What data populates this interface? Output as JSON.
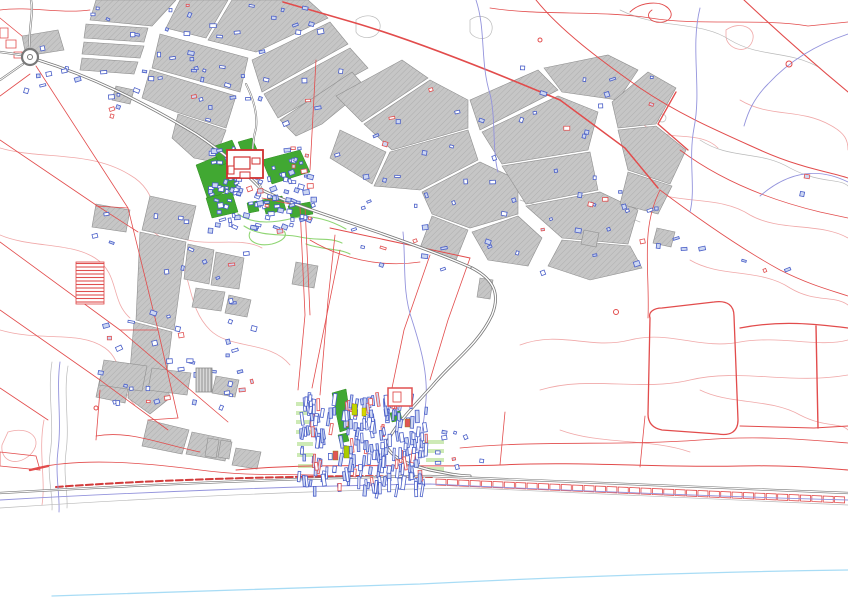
{
  "app": {
    "title": "Cadastral GIS map view"
  },
  "canvas": {
    "width": 848,
    "height": 599,
    "background": "#ffffff"
  },
  "palette": {
    "parcel_fill": "#c6c6c6",
    "parcel_hatch": "#aeaeae",
    "parcel_stroke": "#8f8f8f",
    "red": "#e24c4c",
    "red_dark": "#d23b3b",
    "pink": "#f0a8a8",
    "green": "#41a832",
    "green_stroke": "#2f8c20",
    "light_green": "#cdeab5",
    "track_green": "#8fd573",
    "blue": "#4a5fc8",
    "blue_fill": "#cdd7f2",
    "purple": "#9393dc",
    "coast_blue": "#a8dcf5",
    "road": "#787878",
    "road_core": "#ffffff",
    "gray_line": "#b9b9b9"
  },
  "map": {
    "contours_pink": [
      "M0,148 C40,160 90,150 130,175 C160,192 150,220 175,235 C200,250 240,235 262,248",
      "M0,235 C30,248 70,242 95,258 C120,274 110,300 130,318",
      "M0,330 C40,342 80,330 105,348 C125,362 118,390 135,405",
      "M8,432 C30,425 45,440 30,455 C15,468 0,460 2,445 Z",
      "M150,230 C200,260 180,300 210,330 C230,350 270,340 290,365",
      "M520,345 C560,330 590,350 630,340 C670,330 700,350 740,342 C780,335 820,348 848,340",
      "M540,390 C590,375 640,392 690,380 C740,368 790,385 848,375",
      "M600,60 C630,78 620,110 648,128 C670,142 700,130 718,148",
      "M726,30 C740,20 758,28 752,42 C746,56 726,48 726,36 Z",
      "M648,190 C680,205 720,195 750,215 C780,232 820,222 848,238",
      "M690,260 C720,278 760,268 790,288 C815,303 835,295 848,305",
      "M700,390 C730,405 770,398 800,415 C825,428 840,422 848,430",
      "M560,430 C600,445 650,438 690,452",
      "M740,100 C770,118 800,108 830,125 C845,133 848,140 848,150",
      "M44,420 C38,450 46,480 42,505"
    ],
    "contours_gray": [
      "M620,10 C660,30 700,20 730,40 C760,58 790,50 820,68",
      "M520,200 C560,215 600,205 640,222",
      "M700,140 C730,160 760,150 790,168 C820,184 840,178 848,186",
      "M356,20 C366,12 382,16 380,28 C378,40 360,40 356,32 Z",
      "M470,20 C480,12 494,18 492,30 C490,42 474,40 470,32 Z",
      "M52,362 C47,392 55,424 50,454 C47,477 53,494 52,510",
      "M68,366 C63,394 70,424 66,452 C63,476 68,492 67,508"
    ],
    "contour_circles": [
      [
        652,
        82,
        6
      ],
      [
        668,
        92,
        5
      ],
      [
        662,
        118,
        4
      ]
    ],
    "gray_parcels": [
      "96,0 176,0 152,26 90,20",
      "180,0 228,0 206,38 166,28",
      "232,0 308,0 328,18 256,52 208,40",
      "160,34 248,58 240,92 152,68",
      "150,70 236,96 226,128 176,112 142,98",
      "252,60 330,22 348,44 262,92",
      "264,94 350,48 368,68 278,118",
      "178,114 226,130 214,162 194,158 172,138",
      "86,24 148,28 144,42 84,38",
      "84,42 144,46 140,58 82,54",
      "82,58 138,62 134,74 80,70",
      "22,36 58,30 64,50 26,56",
      "116,86 134,90 130,104 112,100",
      "280,120 352,72 366,88 322,124 296,136",
      "336,96 402,60 428,78 362,122",
      "364,124 430,80 468,100 468,128 392,150",
      "340,130 386,152 372,184 330,158",
      "390,152 468,130 478,160 420,190 374,186",
      "422,192 480,162 518,180 518,214 470,228 432,214",
      "470,100 538,70 558,90 480,130",
      "544,68 608,55 638,70 618,100 562,92",
      "482,132 558,96 598,112 588,150 502,164",
      "502,166 590,152 598,190 526,204",
      "526,206 600,192 638,210 628,244 562,238",
      "562,240 630,246 642,268 590,280 548,266",
      "612,102 648,72 676,88 656,124 618,128",
      "618,130 656,126 686,150 670,184 628,170",
      "628,172 672,186 658,214 620,204",
      "432,216 468,230 456,260 420,248",
      "472,232 518,216 542,238 528,266 488,260",
      "150,196 196,206 188,240 142,230",
      "140,232 186,242 174,330 136,320",
      "134,322 172,332 166,380 170,398 150,414 128,398 131,358",
      "188,244 214,250 209,284 184,279",
      "216,252 244,258 239,289 211,285",
      "96,204 130,210 126,232 92,227",
      "196,288 225,292 221,311 192,307",
      "229,295 251,300 247,317 225,313",
      "100,378 129,384 125,403 96,397",
      "104,360 147,366 142,391 99,385",
      "152,368 191,373 187,395 148,390",
      "216,376 239,380 235,397 212,393",
      "148,420 189,430 182,454 142,446",
      "192,432 231,440 225,461 186,454",
      "236,448 261,452 257,469 232,465",
      "208,438 219,440 216,458 205,456",
      "221,440 232,442 229,459 218,457",
      "480,278 493,280 490,299 477,297",
      "584,230 599,233 596,247 581,244",
      "657,228 675,232 671,247 653,243",
      "296,262 318,266 314,288 292,284"
    ],
    "green_areas": [
      "196,165 228,152 238,186 208,200",
      "212,147 232,140 240,158 220,166",
      "238,142 252,138 258,152 244,157",
      "262,160 300,150 310,172 272,184",
      "206,198 232,192 238,212 212,218",
      "262,200 282,196 286,210 266,214",
      "288,206 310,202 313,214 291,218",
      "247,203 257,201 259,211 249,213",
      "332,393 346,389 352,428 340,432",
      "390,413 400,411 402,420 392,422",
      "338,435 347,433 349,441 340,443"
    ],
    "light_green_strips": [
      [
        296,
        402,
        17,
        4
      ],
      [
        296,
        411,
        17,
        4
      ],
      [
        296,
        420,
        17,
        4
      ],
      [
        296,
        430,
        17,
        4
      ],
      [
        297,
        442,
        16,
        4
      ],
      [
        297,
        453,
        16,
        4
      ],
      [
        298,
        464,
        15,
        4
      ],
      [
        424,
        440,
        20,
        4
      ],
      [
        425,
        449,
        19,
        4
      ],
      [
        426,
        458,
        18,
        4
      ],
      [
        427,
        467,
        17,
        4
      ]
    ],
    "green_tracks": [
      "M238,214 C255,226 278,222 294,218 C312,214 332,221 346,229",
      "M244,226 C262,238 284,233 300,237 C316,241 330,237 342,243",
      "M250,232 C246,241 258,247 272,244 C283,241 288,236 284,231",
      "M306,244 C322,250 338,248 350,254"
    ],
    "red_lines": [
      {
        "d": "M36,66 L128,208 L158,330 L178,418"
      },
      {
        "d": "M30,74 L0,96"
      },
      {
        "d": "M0,140 L96,205 L138,232"
      },
      {
        "d": "M0,242 L120,330 L228,422"
      },
      {
        "d": "M0,310 L100,380 L168,430"
      },
      {
        "d": "M128,208 L96,206"
      },
      {
        "d": "M158,330 L120,330"
      },
      {
        "d": "M0,388 L48,420"
      },
      {
        "d": "M36,468 C80,458 140,462 200,470 C260,478 300,472 340,477"
      },
      {
        "d": "M0,452 L36,456 L40,470 L0,466 Z"
      },
      {
        "d": "M262,198 L300,206 L305,315 L298,390"
      },
      {
        "d": "M305,206 L310,315"
      },
      {
        "d": "M330,228 L470,258",
        "w": 1.0
      },
      {
        "d": "M335,235 L328,300 L320,395"
      },
      {
        "d": "M470,258 L448,320 L430,380"
      },
      {
        "d": "M430,255 L404,330 L392,388"
      },
      {
        "d": "M340,250 L312,388"
      },
      {
        "d": "M310,240 C340,258 380,268 420,262"
      },
      {
        "d": "M650,318 C648,312 654,308 662,308 L714,302 C728,300 734,306 734,316 L738,420 C738,432 730,436 718,434 L662,430 C652,428 648,422 648,414 Z",
        "w": 1.3
      },
      {
        "d": "M740,328 C780,320 816,324 848,328",
        "w": 1.2
      },
      {
        "d": "M740,426 L814,428 L848,426",
        "w": 1.0
      },
      {
        "d": "M816,326 L818,428",
        "w": 1.4
      },
      {
        "d": "M236,470 C320,462 420,468 500,465 C580,461 660,468 740,466 C790,465 820,468 848,470",
        "w": 1.0
      },
      {
        "d": "M500,465 L505,412"
      },
      {
        "d": "M640,467 L645,416"
      },
      {
        "d": "M460,448 C540,440 620,446 700,440 C760,435 810,440 848,443"
      },
      {
        "d": "M283,2 L352,22 C400,36 470,62 560,100",
        "w": 1.6
      },
      {
        "d": "M560,100 L625,148 L658,188",
        "w": 1.5
      },
      {
        "d": "M688,150 L658,124 L676,92",
        "w": 1.3
      },
      {
        "d": "M744,0 C776,30 812,62 848,92",
        "w": 1.1
      },
      {
        "d": "M536,0 C560,30 600,60 640,88 C680,115 720,132 760,150 C800,168 830,172 848,178",
        "w": 1.0
      },
      {
        "d": "M490,8 C540,16 600,10 650,18 C700,26 760,18 808,26 L848,22"
      },
      {
        "d": "M660,190 C700,220 740,248 780,270 C810,285 830,290 848,296"
      },
      {
        "d": "M660,190 C640,230 650,270 648,318"
      },
      {
        "d": "M680,150 C720,180 770,200 820,212 L848,218"
      },
      {
        "d": "M0,18 L22,36"
      },
      {
        "d": "M316,60 L310,170"
      },
      {
        "d": "M96,436 C130,430 160,444 200,452"
      },
      {
        "d": "M96,440 L100,390"
      },
      {
        "d": "M30,470 L48,466",
        "w": 2.4
      },
      {
        "d": "M178,418 L148,420"
      },
      {
        "d": "M0,10 C30,6 60,14 90,10"
      },
      {
        "d": "M630,12 C640,2 660,0 668,8 C676,16 668,24 656,22 C648,20 646,14 652,10",
        "w": 0.9
      },
      {
        "d": "M6,40 h10 v8 h-10 Z"
      },
      {
        "d": "M14,52 h8 v6 h-8 Z"
      },
      {
        "d": "M0,28 h8 v10 h-8 Z"
      }
    ],
    "coast_dash": {
      "d": "M56,487 C150,480 260,477 360,476 L432,477",
      "w": 2.0,
      "dash": "7 3"
    },
    "coast_ladder": {
      "x1": 436,
      "y1": 479,
      "x2": 846,
      "y2": 497,
      "n": 36,
      "h": 6,
      "w": 0.8
    },
    "streams": [
      "M60,362 C56,390 62,420 58,450 C55,475 60,495 59,512",
      "M403,232 C406,262 402,292 412,320 C420,345 428,372 426,400 C424,424 420,444 418,456",
      "M700,8 C690,48 702,88 694,128 C688,160 696,188 690,212",
      "M848,34 C818,44 790,60 768,84 C754,98 748,112 744,126",
      "M760,196 C790,170 820,168 848,182",
      "M476,0 C486,30 480,62 490,94 C496,118 492,150 498,172",
      "M0,500 C140,492 300,486 430,484 C560,490 700,496 848,500"
    ],
    "coast_parallel_gray": "M0,508 C150,498 320,490 470,488 C620,494 740,500 848,505",
    "coastline": "M52,596 C180,592 300,588 420,584 C560,577 700,572 848,570",
    "roads": [
      {
        "d": "M38,60 C90,76 140,100 196,134 C232,158 248,176 262,190 C290,204 330,216 380,233 C420,247 450,258 472,268",
        "casing": 3.0,
        "core": 1.4
      },
      {
        "d": "M472,268 C495,280 500,295 492,315 C478,345 452,362 433,385 C415,405 392,428 386,445 C392,458 406,464 430,470 C450,474 460,476 470,476",
        "casing": 3.0,
        "core": 1.4
      },
      {
        "d": "M0,493 C140,485 300,478 430,476 C560,482 700,488 848,493",
        "casing": 2.2,
        "core": 1.0
      },
      {
        "d": "M0,52 L22,55",
        "casing": 2.2,
        "core": 1.0
      },
      {
        "d": "M0,80 L23,64",
        "casing": 2.2,
        "core": 1.0
      },
      {
        "d": "M30,48 C28,30 34,14 31,0",
        "casing": 2.2,
        "core": 1.0
      },
      {
        "d": "M262,190 C252,170 250,150 256,128 C258,112 252,96 246,84",
        "casing": 2.0,
        "core": 0.9
      }
    ],
    "roundabout": {
      "cx": 30,
      "cy": 57,
      "r": 8,
      "r2": 2.5
    },
    "villages": [
      {
        "x": 208,
        "y": 146,
        "w": 104,
        "h": 84,
        "count": 115,
        "seed": 7,
        "type": "blocks"
      },
      {
        "x": 298,
        "y": 392,
        "w": 128,
        "h": 96,
        "count": 230,
        "seed": 13,
        "type": "strips"
      }
    ],
    "scatter_regions": [
      {
        "x": 88,
        "y": 4,
        "w": 236,
        "h": 120,
        "count": 55,
        "seed": 21
      },
      {
        "x": 334,
        "y": 62,
        "w": 320,
        "h": 210,
        "count": 60,
        "seed": 22
      },
      {
        "x": 88,
        "y": 198,
        "w": 170,
        "h": 220,
        "count": 38,
        "seed": 23
      },
      {
        "x": 100,
        "y": 356,
        "w": 140,
        "h": 46,
        "count": 16,
        "seed": 24
      },
      {
        "x": 580,
        "y": 190,
        "w": 100,
        "h": 60,
        "count": 10,
        "seed": 25
      },
      {
        "x": 650,
        "y": 170,
        "w": 180,
        "h": 120,
        "count": 7,
        "seed": 26
      },
      {
        "x": 430,
        "y": 430,
        "w": 60,
        "h": 44,
        "count": 9,
        "seed": 27
      },
      {
        "x": 20,
        "y": 30,
        "w": 60,
        "h": 60,
        "count": 8,
        "seed": 28
      }
    ],
    "landmarks": {
      "manor_outer": [
        227,
        150,
        36,
        28
      ],
      "manor_inner": [
        234,
        157,
        16,
        12
      ],
      "manor_wings": [
        [
          252,
          158,
          8,
          6
        ],
        [
          240,
          172,
          10,
          6
        ],
        [
          228,
          166,
          6,
          8
        ]
      ],
      "greenhouse": [
        76,
        262,
        28,
        42
      ],
      "barn": [
        196,
        368,
        16,
        24
      ],
      "big_red_building": [
        388,
        388,
        24,
        18
      ],
      "big_red_inner": [
        393,
        392,
        8,
        10
      ],
      "red_circles": [
        [
          789,
          64,
          3
        ],
        [
          616,
          312,
          2.5
        ],
        [
          96,
          408,
          2
        ],
        [
          540,
          40,
          2
        ]
      ],
      "highlights": [
        [
          352,
          404,
          5,
          11,
          "#c2d500"
        ],
        [
          344,
          446,
          5,
          12,
          "#aacc00"
        ],
        [
          362,
          408,
          4,
          8,
          "#d8d800"
        ],
        [
          333,
          451,
          5,
          9,
          "#e05555"
        ],
        [
          405,
          419,
          5,
          8,
          "#e05555"
        ]
      ]
    }
  }
}
